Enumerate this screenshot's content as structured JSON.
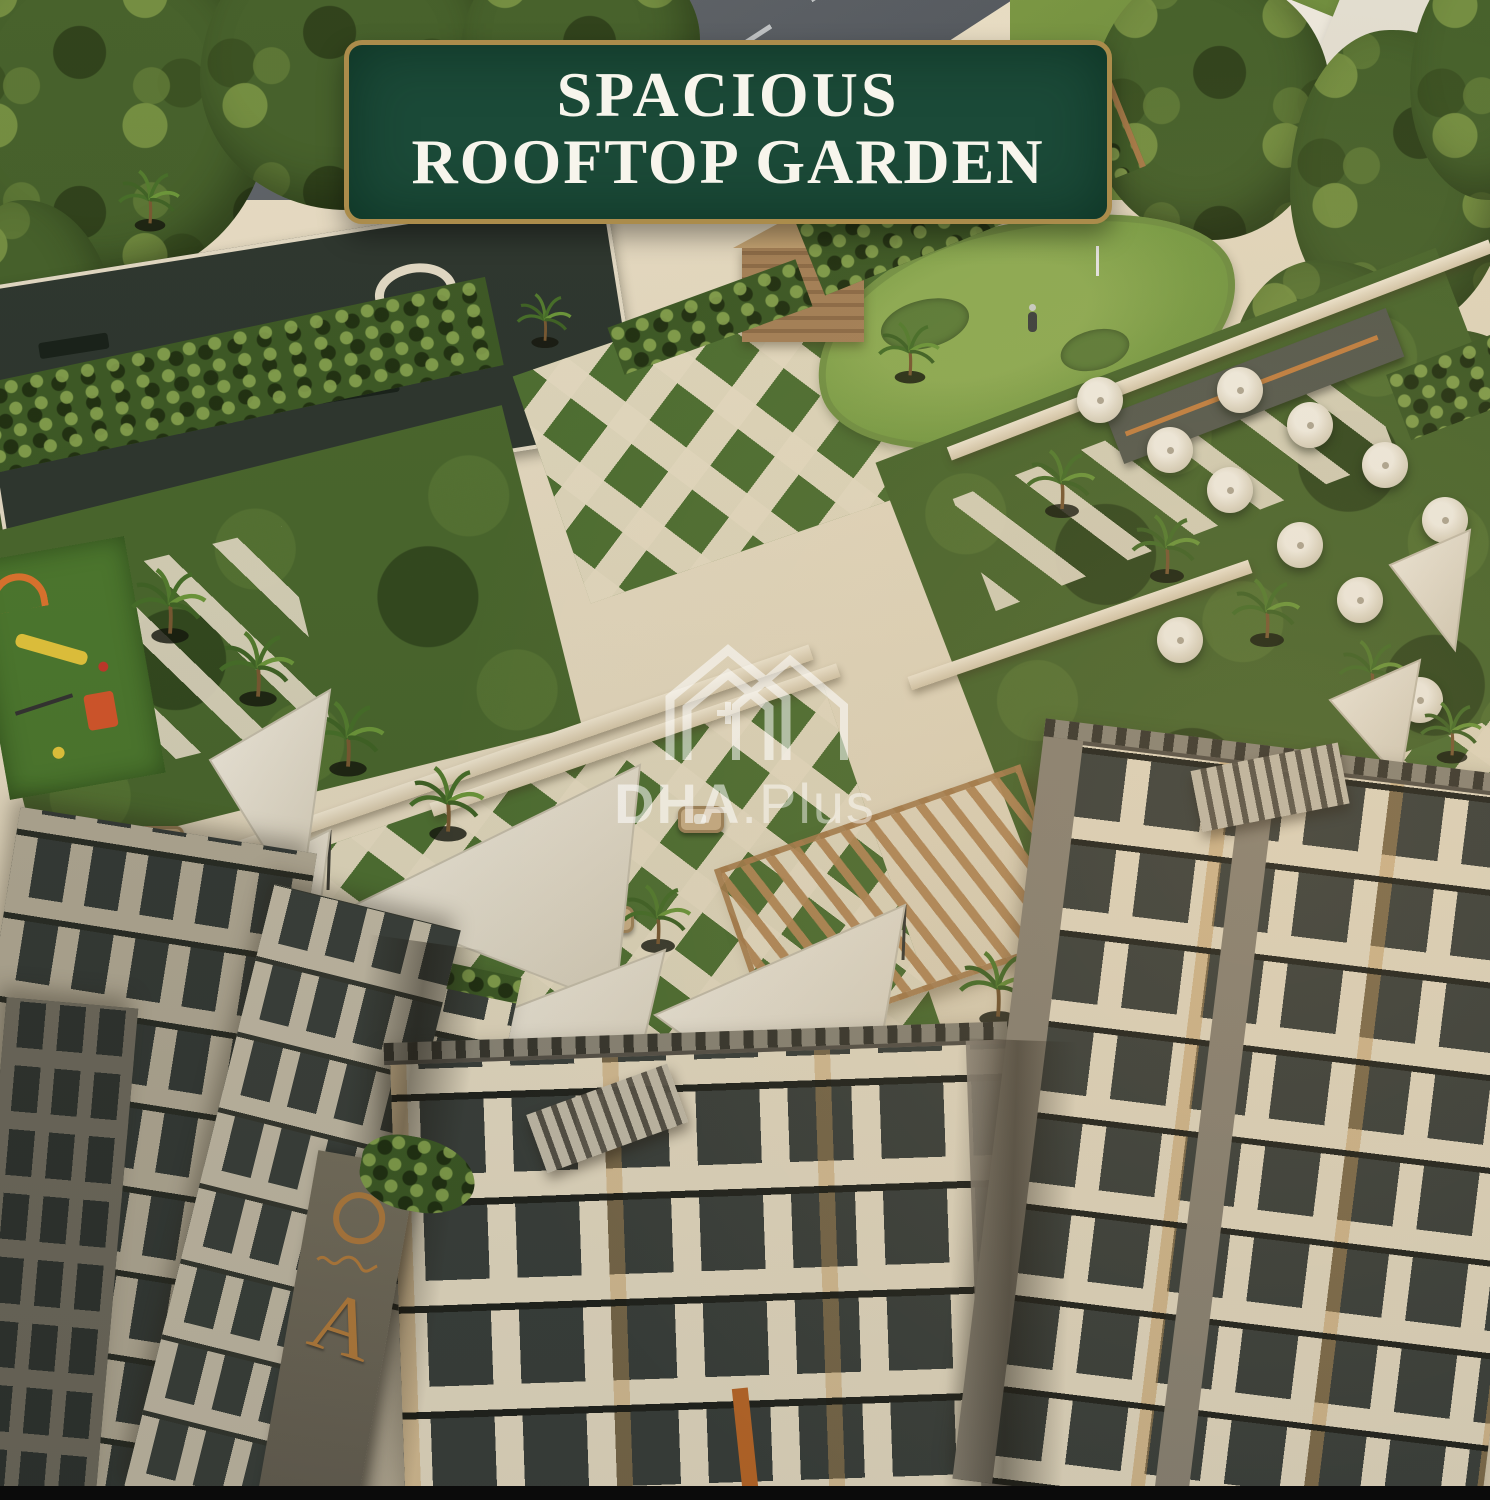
{
  "banner": {
    "line1": "SPACIOUS",
    "line2": "ROOFTOP GARDEN"
  },
  "watermark": {
    "logo_icon": "twin-house-plus-icon",
    "brand": "DHA",
    "suffix": ".Plus"
  },
  "tower_sign": {
    "emblem_icon": "gold-ring-emblem-icon",
    "letter": "A"
  },
  "palette": {
    "banner-green": "#1b4a38",
    "banner-border": "#ab8c4b",
    "banner-text": "#f7f5ec",
    "roof-cream": "#eadfc8",
    "lawn-green": "#49682e",
    "checker-green": "#4e7133",
    "paver-cream": "#eae0c7",
    "tree-green": "#45622c",
    "road-gray": "#5b6168",
    "car-blue": "#2f6fb3",
    "facade-cream": "#e9dfc7",
    "facade-gray": "#8d8678",
    "window-dark": "#3a403d",
    "wood-tan": "#b3885a",
    "sail-white": "#f4efe3",
    "play-orange": "#e2762f",
    "play-yellow": "#e8c93d",
    "sign-gold": "#b57d3e",
    "black-strip": "#0b0b0b"
  }
}
